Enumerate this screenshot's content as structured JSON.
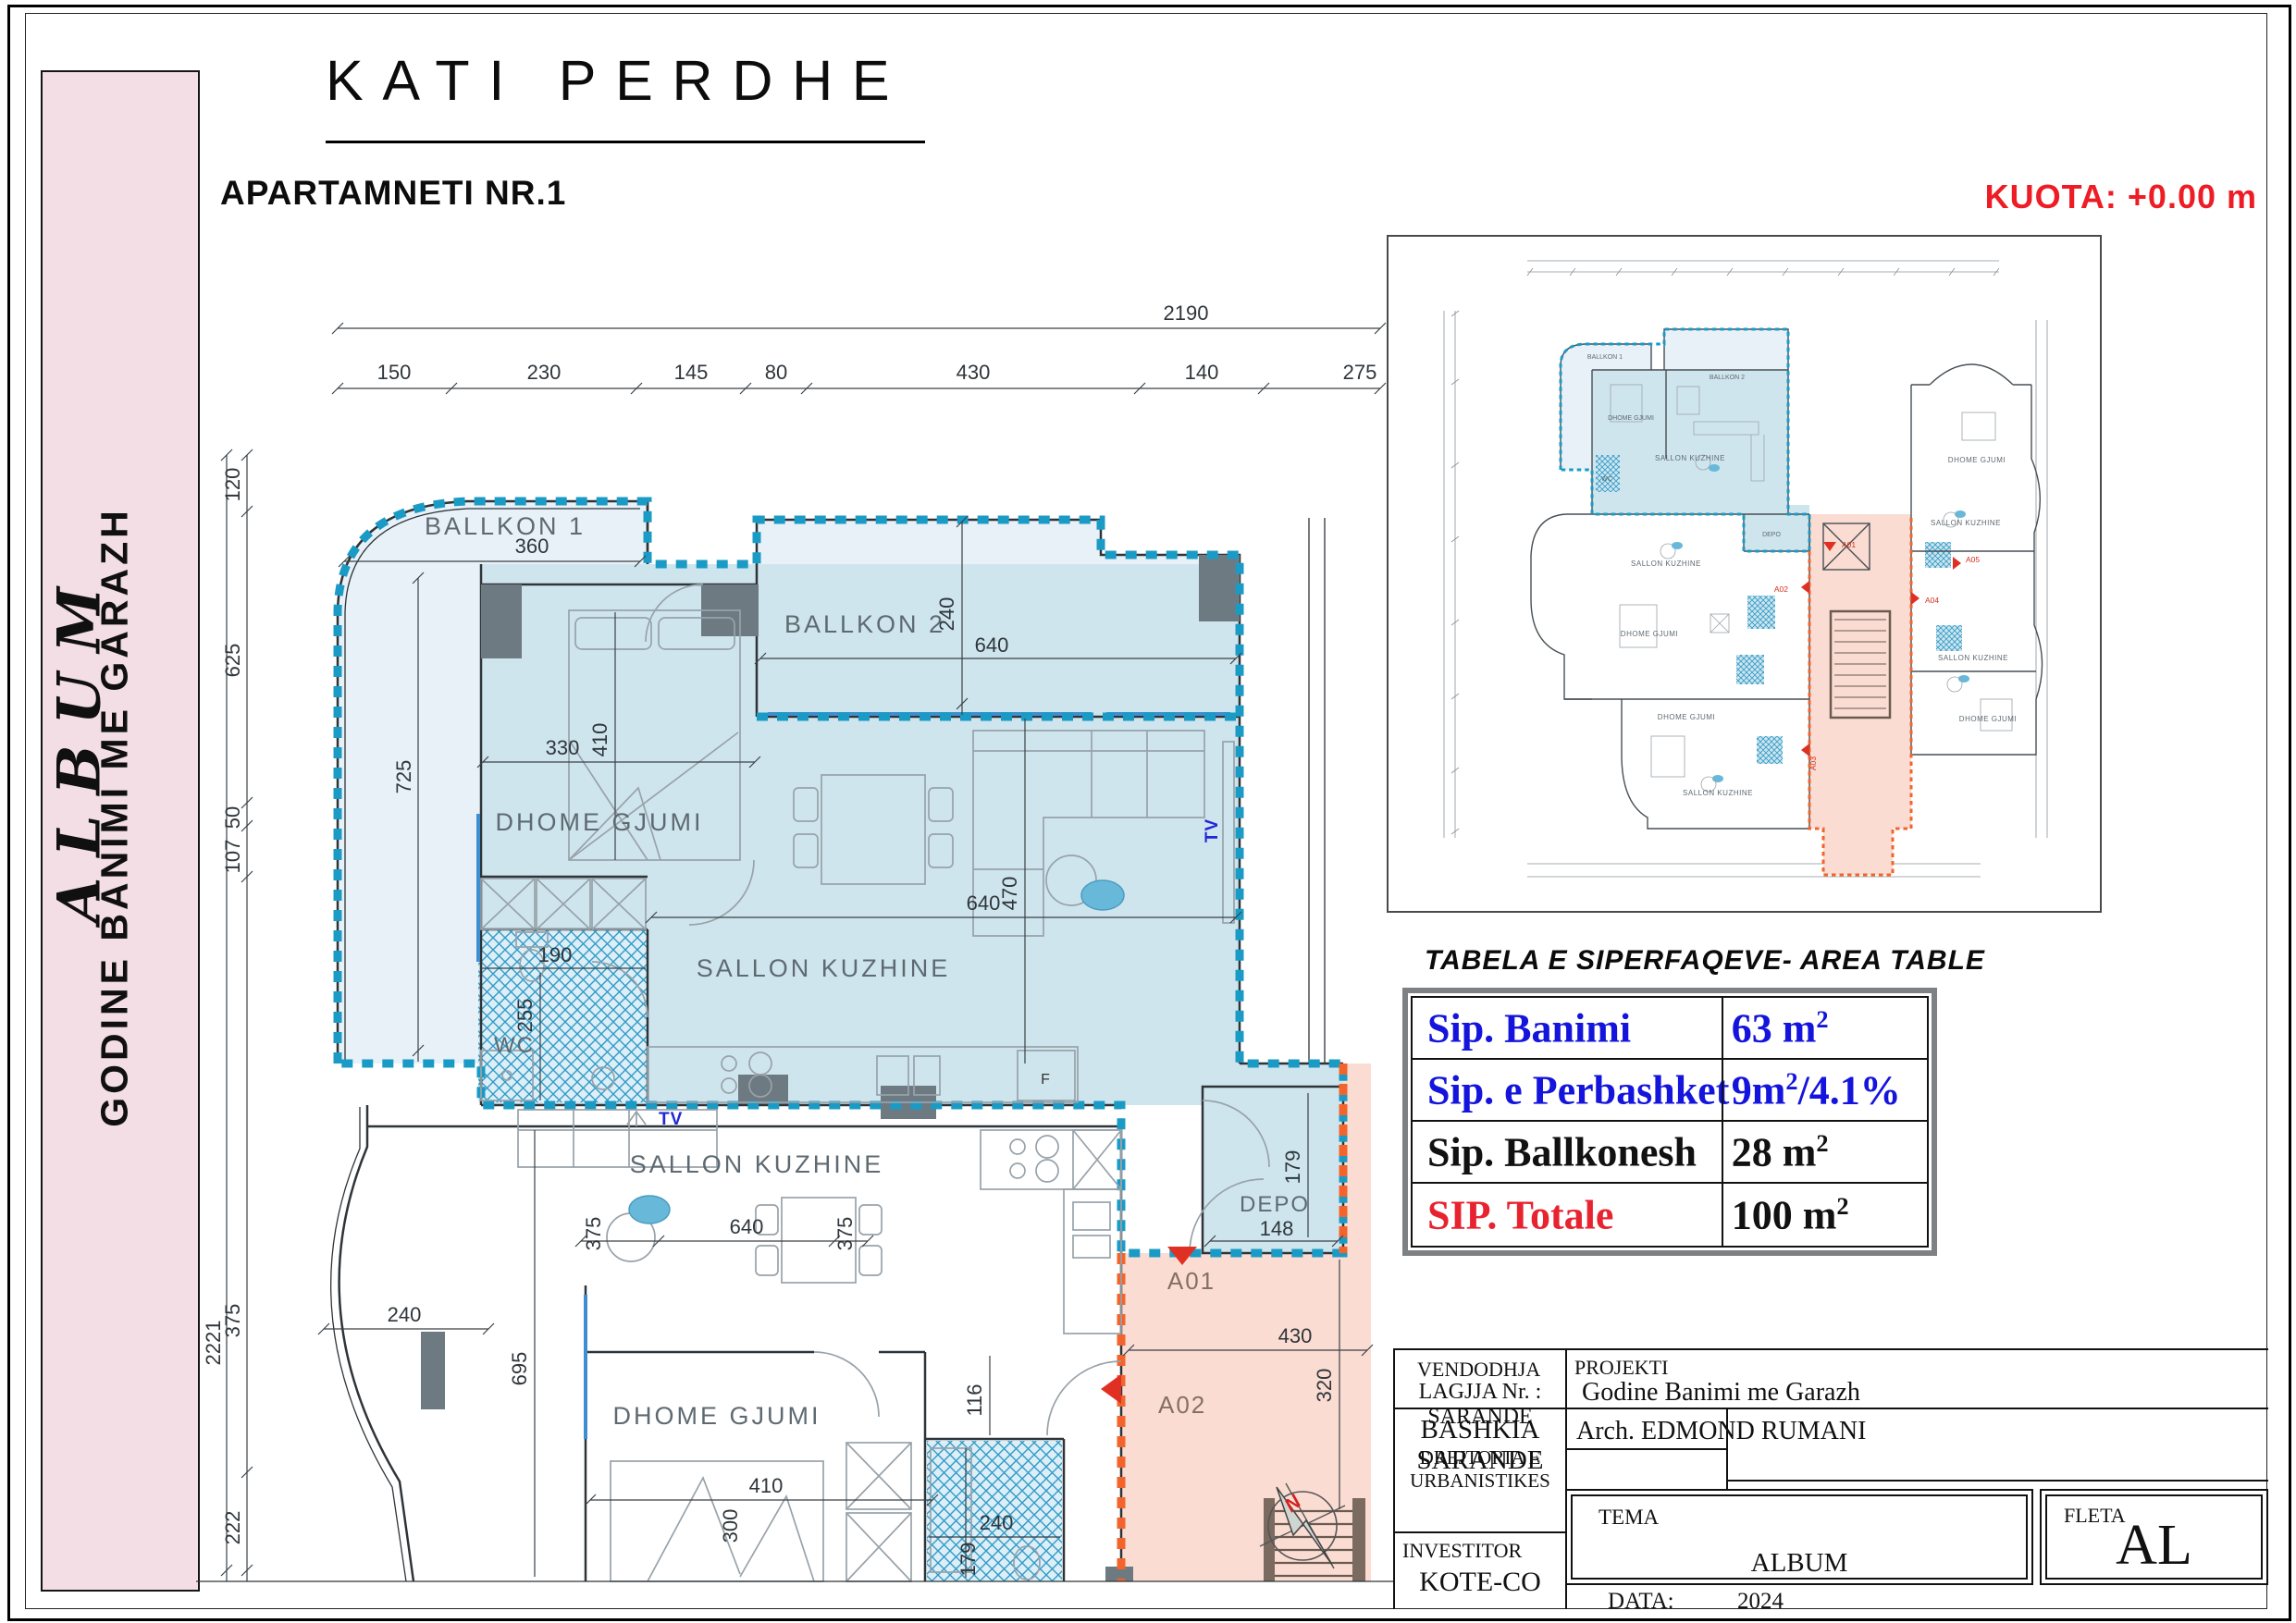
{
  "colors": {
    "accent_teal": "#1a9bc6",
    "accent_orange": "#f2642c",
    "apartment_fill": "#cfe5ee",
    "balcony_fill": "#e7f1f7",
    "common_fill": "#fadcd2",
    "table_blue": "#1414dd",
    "table_red": "#e82330",
    "kuota_red": "#ee1c25",
    "wall_gray": "#6e7a82",
    "sidebar_pink": "#f2dee4"
  },
  "page": {
    "title": "KATI PERDHE",
    "subtitle": "APARTAMNETI NR.1",
    "kuota": "KUOTA: +0.00 m",
    "sidebar": {
      "album": "ALBUM",
      "subtitle": "GODINE BANIMI  ME GARAZH"
    }
  },
  "rooms": {
    "ballkon1": "BALLKON 1",
    "ballkon2": "BALLKON 2",
    "dhome_gjumi": "DHOME GJUMI",
    "sallon_kuzhine": "SALLON  KUZHINE",
    "wc": "WC",
    "depo": "DEPO",
    "tv": "TV",
    "fridge": "F"
  },
  "doors": {
    "a01": "A01",
    "a02": "A02",
    "a03": "A03",
    "a04": "A04",
    "a05": "A05"
  },
  "compass": {
    "north": "N"
  },
  "dims": {
    "top_total": "2190",
    "top_segments": [
      "150",
      "230",
      "145",
      "80",
      "430",
      "140",
      "275"
    ],
    "left_total": "2221",
    "left_segments": [
      "120",
      "625",
      "50",
      "107",
      "375",
      "222"
    ],
    "ballkon1_w": "360",
    "ballkon1_h": "725",
    "bed_w": "330",
    "bed_h": "410",
    "ballkon2_h": "240",
    "ballkon2_w": "640",
    "sallon_w": "640",
    "sallon_h": "470",
    "wc_w": "190",
    "wc_h": "255",
    "depo_w": "148",
    "depo_h": "179",
    "hall_w": "430",
    "hall_h": "320",
    "low_left": "375",
    "low_mid": "640",
    "low_right": "375",
    "low_240": "240",
    "low_695": "695",
    "low_116": "116",
    "bed2_w": "410",
    "bed2_h": "300",
    "bath_w": "240",
    "bath_h": "179"
  },
  "area_table": {
    "title": "TABELA E SIPERFAQEVE- AREA TABLE",
    "rows": [
      {
        "label": "Sip. Banimi",
        "pre": "63 m",
        "sup": "2",
        "post": ""
      },
      {
        "label": "Sip. e Perbashket",
        "pre": "9m",
        "sup": "2",
        "post": "/4.1%"
      },
      {
        "label": "Sip. Ballkonesh",
        "pre": "28 m",
        "sup": "2",
        "post": ""
      },
      {
        "label": "SIP. Totale",
        "pre": "100 m",
        "sup": "2",
        "post": ""
      }
    ]
  },
  "title_block": {
    "vendodhja_label": "VENDODHJA",
    "vendodhja_value": "LAGJJA Nr. : SARANDE",
    "bashkia": "BASHKIA  SARANDE",
    "drejtoria": "DREJTORIA E URBANISTIKES",
    "investitor_label": "INVESTITOR",
    "investitor_value": "KOTE-CO",
    "projekti_label": "PROJEKTI",
    "projekti_value": "Godine Banimi me  Garazh",
    "arch": "Arch.  EDMOND RUMANI",
    "tema_label": "TEMA",
    "tema_value": "ALBUM",
    "fleta_label": "FLETA",
    "fleta_value": "AL",
    "data_label": "DATA:",
    "data_value": "2024"
  }
}
